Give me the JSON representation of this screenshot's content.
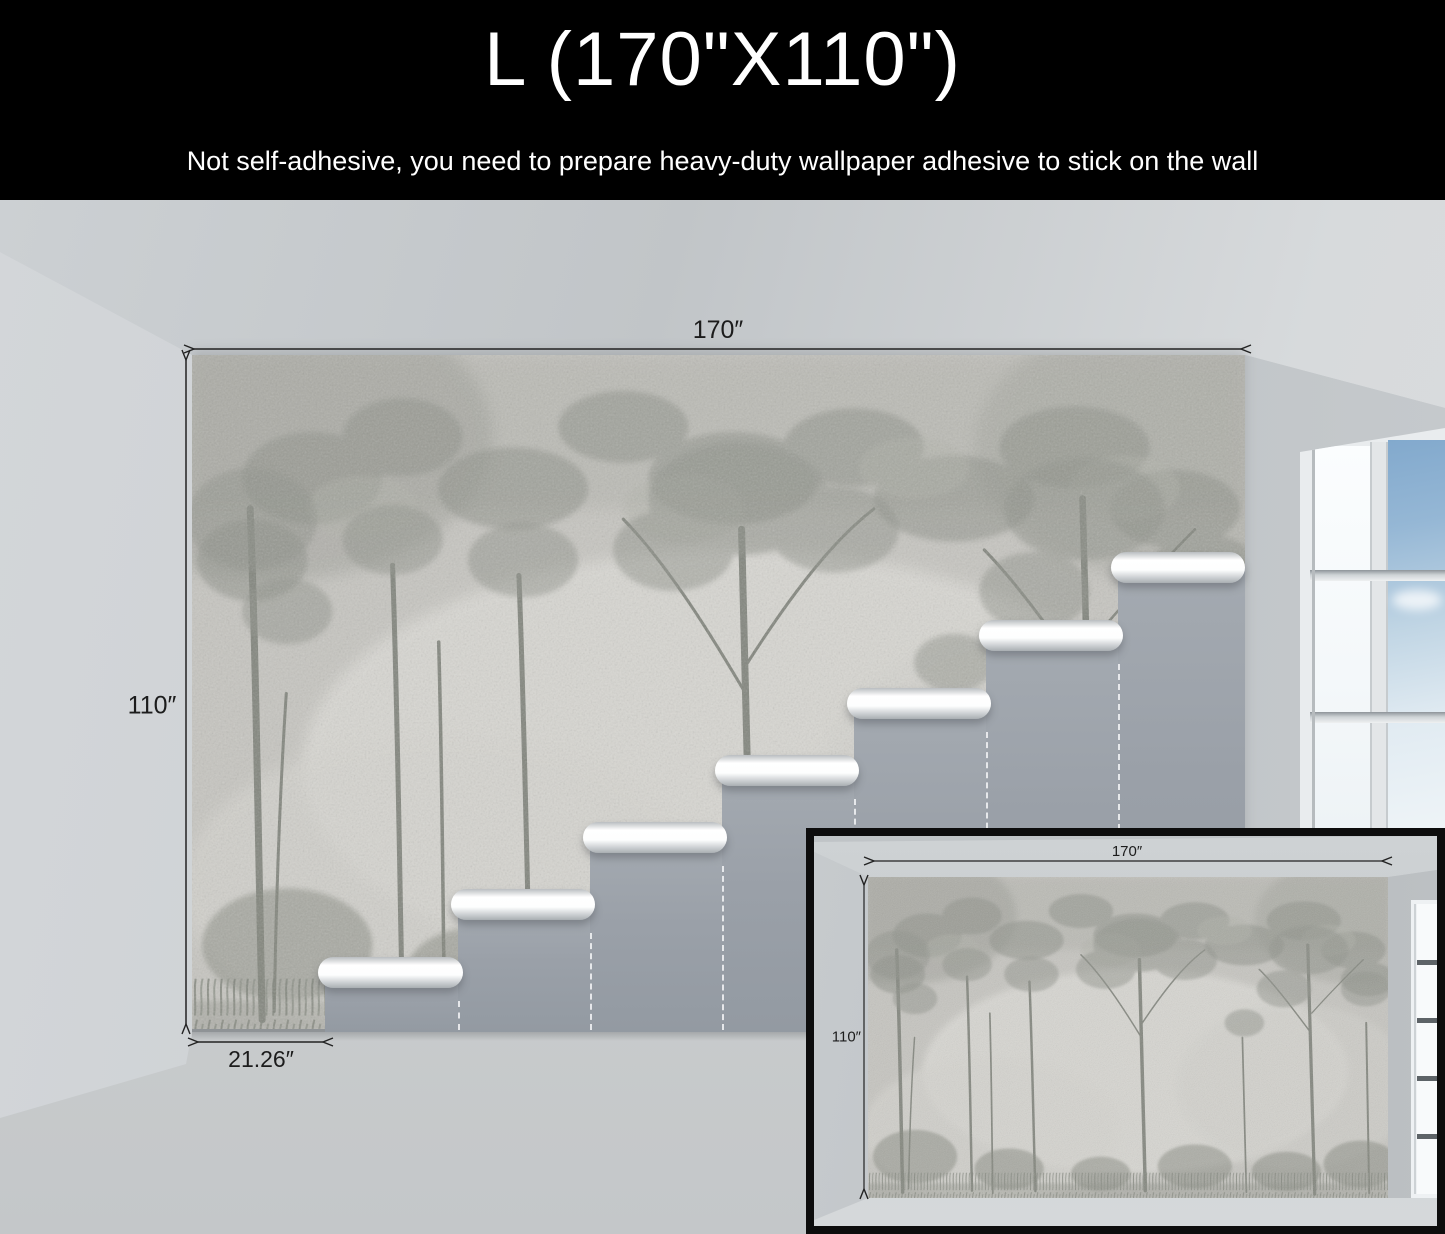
{
  "header": {
    "size_label": "L (170\"X110\")",
    "note": "Not self-adhesive, you need to prepare heavy-duty wallpaper adhesive to stick on the wall"
  },
  "main_view": {
    "width_label": "170″",
    "height_label": "110″",
    "panel_width_label": "21.26″"
  },
  "inset_view": {
    "width_label": "170″",
    "height_label": "110″"
  },
  "colors": {
    "header_bg": "#000000",
    "header_text": "#ffffff",
    "dimension_line": "#222222",
    "stair_panel": "#9aa0a8",
    "sky": "#7fa9cf",
    "mural_base": "#c6c5c0"
  }
}
